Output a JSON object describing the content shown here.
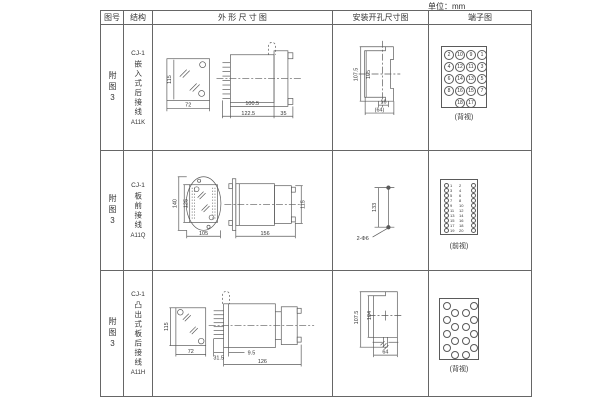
{
  "unit_label": "单位：mm",
  "header": {
    "fig": "图号",
    "struct": "结构",
    "outline": "外 形 尺 寸 图",
    "mount": "安装开孔尺寸图",
    "terminal": "端子图"
  },
  "rows": [
    {
      "fig": "附图3",
      "model": "CJ-1",
      "desc": "嵌入式后接线",
      "code": "A11K",
      "outline": {
        "height": "115",
        "width": "72",
        "body_len": "100.5",
        "total_len": "122.5",
        "flange": "35"
      },
      "mount": {
        "outer_h": "107.5",
        "inner_h": "105",
        "slot_w": "16",
        "overall_w": "(64)"
      },
      "terminal_caption": "(背视)"
    },
    {
      "fig": "附图3",
      "model": "CJ-1",
      "desc": "板前接线",
      "code": "A11Q",
      "outline": {
        "outer_h": "140",
        "inner_h": "125",
        "width": "105",
        "depth": "156",
        "height": "115"
      },
      "mount": {
        "hole_spacing": "133",
        "holes": "2-Φ6"
      },
      "terminal_caption": "(前视)"
    },
    {
      "fig": "附图3",
      "model": "CJ-1",
      "desc": "凸出式板后接线",
      "code": "A11H",
      "outline": {
        "height": "115",
        "width": "72",
        "pin_len": "31.5",
        "offset": "9.5",
        "depth": "126"
      },
      "mount": {
        "outer_h": "107.5",
        "inner_h": "104",
        "width": "64"
      },
      "terminal_caption": "(背视)"
    }
  ],
  "terminals": {
    "row1": {
      "size": 10,
      "items": [
        {
          "x": 2,
          "y": 3,
          "n": "2"
        },
        {
          "x": 13,
          "y": 3,
          "n": "10"
        },
        {
          "x": 24,
          "y": 3,
          "n": "9"
        },
        {
          "x": 35,
          "y": 3,
          "n": "1"
        },
        {
          "x": 2,
          "y": 15,
          "n": "4"
        },
        {
          "x": 13,
          "y": 15,
          "n": "12"
        },
        {
          "x": 24,
          "y": 15,
          "n": "11"
        },
        {
          "x": 35,
          "y": 15,
          "n": "3"
        },
        {
          "x": 2,
          "y": 27,
          "n": "6"
        },
        {
          "x": 13,
          "y": 27,
          "n": "14"
        },
        {
          "x": 24,
          "y": 27,
          "n": "13"
        },
        {
          "x": 35,
          "y": 27,
          "n": "5"
        },
        {
          "x": 2,
          "y": 39,
          "n": "8"
        },
        {
          "x": 13,
          "y": 39,
          "n": "16"
        },
        {
          "x": 24,
          "y": 39,
          "n": "15"
        },
        {
          "x": 35,
          "y": 39,
          "n": "7"
        },
        {
          "x": 13,
          "y": 51,
          "n": "18"
        },
        {
          "x": 24,
          "y": 51,
          "n": "17"
        }
      ]
    },
    "row2": {
      "size": 5,
      "items": [
        {
          "x": 3,
          "y": 3
        },
        {
          "x": 9,
          "y": 3,
          "n": "1",
          "t": "txt"
        },
        {
          "x": 18,
          "y": 3,
          "n": "2",
          "t": "txt"
        },
        {
          "x": 30,
          "y": 3
        },
        {
          "x": 3,
          "y": 8
        },
        {
          "x": 9,
          "y": 8,
          "n": "3",
          "t": "txt"
        },
        {
          "x": 18,
          "y": 8,
          "n": "4",
          "t": "txt"
        },
        {
          "x": 30,
          "y": 8
        },
        {
          "x": 3,
          "y": 13
        },
        {
          "x": 9,
          "y": 13,
          "n": "5",
          "t": "txt"
        },
        {
          "x": 18,
          "y": 13,
          "n": "6",
          "t": "txt"
        },
        {
          "x": 30,
          "y": 13
        },
        {
          "x": 3,
          "y": 18
        },
        {
          "x": 9,
          "y": 18,
          "n": "7",
          "t": "txt"
        },
        {
          "x": 18,
          "y": 18,
          "n": "8",
          "t": "txt"
        },
        {
          "x": 30,
          "y": 18
        },
        {
          "x": 3,
          "y": 23
        },
        {
          "x": 9,
          "y": 23,
          "n": "9",
          "t": "txt"
        },
        {
          "x": 18,
          "y": 23,
          "n": "10",
          "t": "txt"
        },
        {
          "x": 30,
          "y": 23
        },
        {
          "x": 3,
          "y": 28
        },
        {
          "x": 9,
          "y": 28,
          "n": "11",
          "t": "txt"
        },
        {
          "x": 18,
          "y": 28,
          "n": "12",
          "t": "txt"
        },
        {
          "x": 30,
          "y": 28
        },
        {
          "x": 3,
          "y": 33
        },
        {
          "x": 9,
          "y": 33,
          "n": "13",
          "t": "txt"
        },
        {
          "x": 18,
          "y": 33,
          "n": "14",
          "t": "txt"
        },
        {
          "x": 30,
          "y": 33
        },
        {
          "x": 3,
          "y": 38
        },
        {
          "x": 9,
          "y": 38,
          "n": "15",
          "t": "txt"
        },
        {
          "x": 18,
          "y": 38,
          "n": "16",
          "t": "txt"
        },
        {
          "x": 30,
          "y": 38
        },
        {
          "x": 3,
          "y": 43
        },
        {
          "x": 9,
          "y": 43,
          "n": "17",
          "t": "txt"
        },
        {
          "x": 18,
          "y": 43,
          "n": "18",
          "t": "txt"
        },
        {
          "x": 30,
          "y": 43
        },
        {
          "x": 3,
          "y": 48
        },
        {
          "x": 9,
          "y": 48,
          "n": "19",
          "t": "txt"
        },
        {
          "x": 18,
          "y": 48,
          "n": "20",
          "t": "txt"
        },
        {
          "x": 30,
          "y": 48
        }
      ]
    },
    "row3": {
      "size": 8,
      "items": [
        {
          "x": 3,
          "y": 3
        },
        {
          "x": 3,
          "y": 17
        },
        {
          "x": 3,
          "y": 31
        },
        {
          "x": 3,
          "y": 45
        },
        {
          "x": 11,
          "y": 10
        },
        {
          "x": 11,
          "y": 24
        },
        {
          "x": 11,
          "y": 38
        },
        {
          "x": 11,
          "y": 52
        },
        {
          "x": 22,
          "y": 10
        },
        {
          "x": 22,
          "y": 24
        },
        {
          "x": 22,
          "y": 38
        },
        {
          "x": 22,
          "y": 52
        },
        {
          "x": 30,
          "y": 3
        },
        {
          "x": 30,
          "y": 17
        },
        {
          "x": 30,
          "y": 31
        },
        {
          "x": 30,
          "y": 45
        }
      ]
    }
  }
}
